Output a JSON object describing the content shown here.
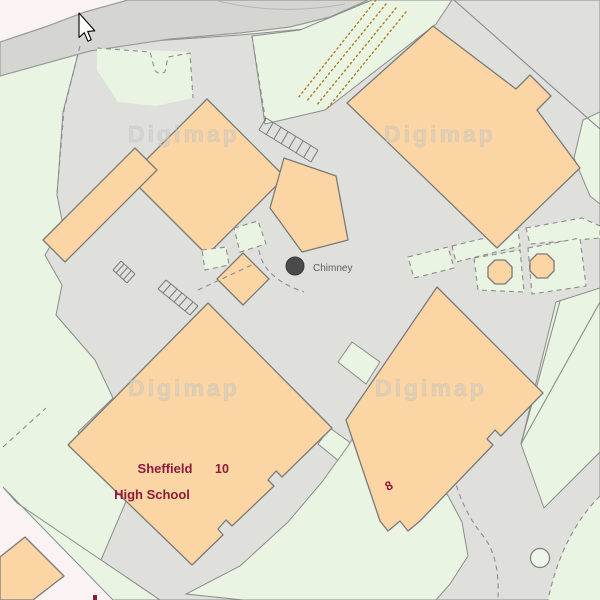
{
  "map": {
    "watermark": "Digimap",
    "labels": {
      "school_name_line1": "Sheffield",
      "school_name_line2": "High School",
      "building_10": "10",
      "building_8": "8",
      "chimney": "Chimney"
    },
    "icons": {
      "cursor": "arrow-pointer",
      "chimney_marker": "filled-circle",
      "tree_ring": "open-circle"
    },
    "colors": {
      "building_fill": "#FBD5A3",
      "building_outline": "#7A7A7A",
      "paved_grey": "#DFDFDC",
      "road_grey": "#D5D5D2",
      "grass_green": "#E9F5E2",
      "road_pink": "#FBF2F4",
      "label_maroon": "#8E1B3C",
      "annotation_grey": "#5D5D5D",
      "vegetation_dots_orange": "#B07A20",
      "watermark_grey": "#CBCBCB"
    }
  }
}
